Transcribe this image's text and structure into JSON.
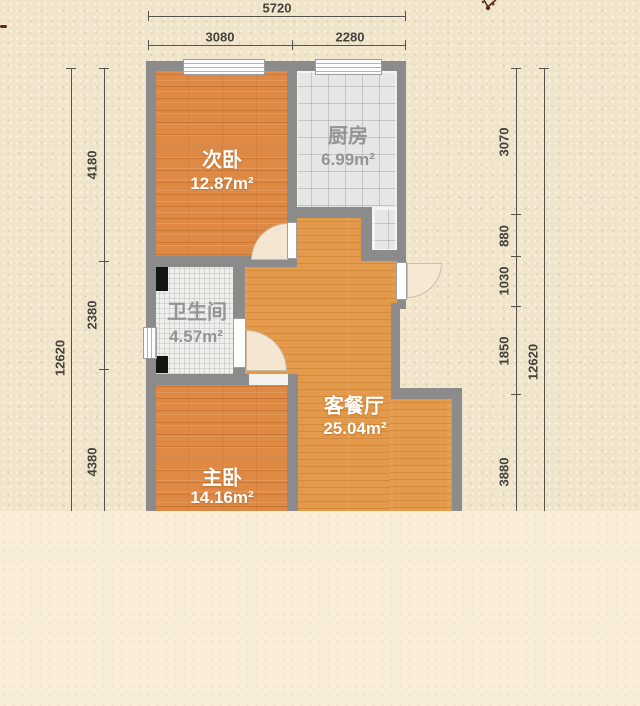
{
  "rooms": [
    {
      "key": "secondary-bedroom",
      "name": "次卧",
      "area": "12.87m²"
    },
    {
      "key": "kitchen",
      "name": "厨房",
      "area": "6.99m²"
    },
    {
      "key": "bathroom",
      "name": "卫生间",
      "area": "4.57m²"
    },
    {
      "key": "living-dining",
      "name": "客餐厅",
      "area": "25.04m²"
    },
    {
      "key": "master-bedroom",
      "name": "主卧",
      "area": "14.16m²"
    }
  ],
  "dims": {
    "top": {
      "total": "5720",
      "segments": [
        "3080",
        "2280"
      ]
    },
    "left": {
      "total": "12620",
      "segments": [
        "4180",
        "2380",
        "4380"
      ]
    },
    "right": {
      "total": "12620",
      "segments": [
        "3070",
        "880",
        "1030",
        "1850",
        "3880"
      ]
    }
  },
  "colors": {
    "wall": "#8b8b8b",
    "bedroom_floor": "#de8a44",
    "living_floor": "#e49a4b",
    "kitchen_tile": "#e6e7e5",
    "bathroom_tile": "#efefeb",
    "background_top": "#f0e5cb",
    "background_bottom": "#f8edd6",
    "dimension_text": "#44423a",
    "label_white": "#ffffff",
    "label_gray": "#949494",
    "decor": "#5b2a1e"
  }
}
